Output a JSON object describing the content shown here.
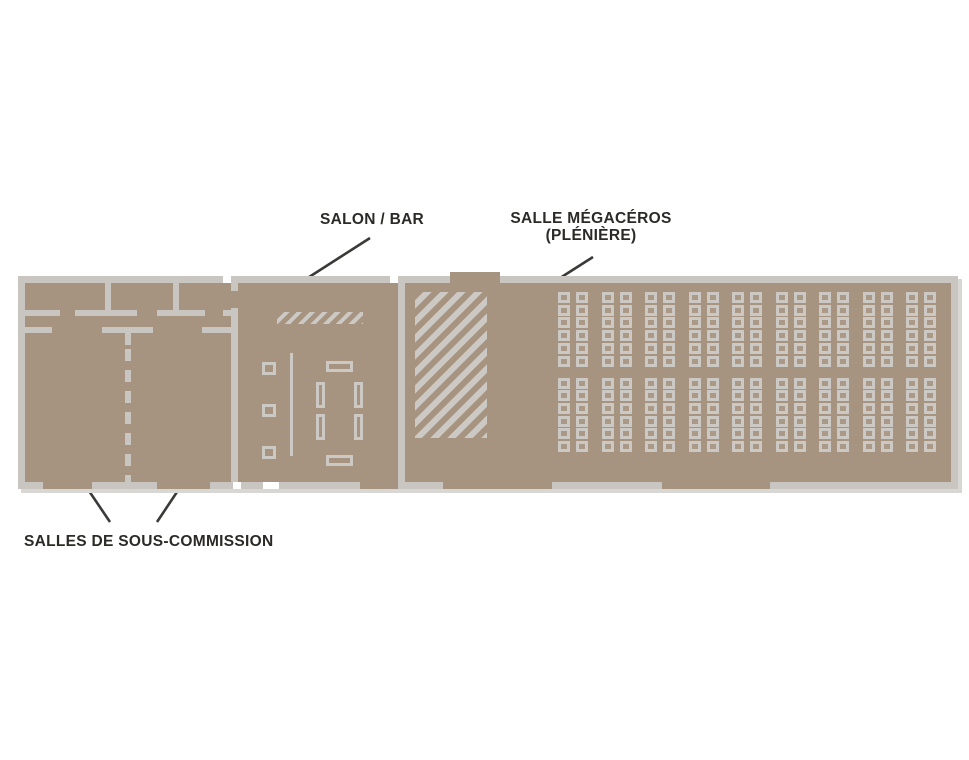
{
  "diagram": {
    "type": "floor-plan",
    "labels": {
      "salon_bar": "SALON / BAR",
      "plenary_line1": "SALLE MÉGACÉROS",
      "plenary_line2": "(PLÉNIÈRE)",
      "sub_commission": "SALLES DE SOUS-COMMISSION"
    },
    "rooms": [
      {
        "name": "salon-bar",
        "label": "SALON / BAR"
      },
      {
        "name": "salle-megaceros",
        "label": "SALLE MÉGACÉROS (PLÉNIÈRE)"
      },
      {
        "name": "salles-de-sous-commission",
        "label": "SALLES DE SOUS-COMMISSION"
      }
    ],
    "seating": {
      "column_pairs": 9,
      "columns_per_pair": 2,
      "row_blocks": 2,
      "rows_per_block": 6,
      "total_seats": 216
    },
    "colors": {
      "floor": "#a69480",
      "wall": "#c9c6c2",
      "wall_shadow": "#d9d7d4",
      "furniture": "#ccc9c4",
      "text": "#2b2a27",
      "callout": "#3a3a38",
      "background": "#ffffff"
    }
  }
}
